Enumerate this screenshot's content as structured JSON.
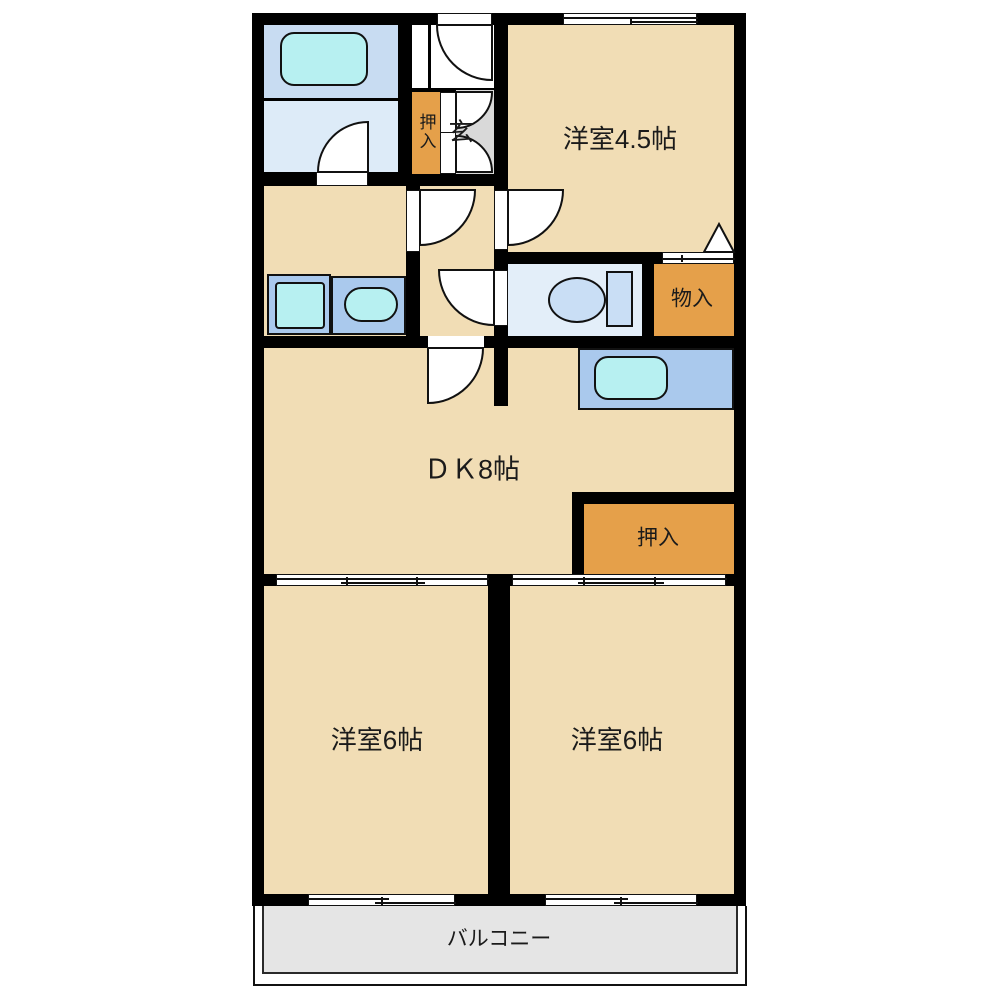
{
  "labels": {
    "western_room_45": "洋室4.5帖",
    "entrance": "玄",
    "closet_upper": "押入",
    "storage": "物入",
    "dining_kitchen": "ＤＫ8帖",
    "closet_dk": "押入",
    "western_room_6_left": "洋室6帖",
    "western_room_6_right": "洋室6帖",
    "balcony": "バルコニー"
  },
  "colors": {
    "wall": "#000000",
    "floor": "#f1ddb5",
    "closet": "#e5a04a",
    "entrance": "#d9d9d9",
    "balcony": "#e5e5e5",
    "bath": "#c8dcf2",
    "washroom": "#ddebf8",
    "toiletroom": "#e3eef9",
    "counter": "#aac9ed",
    "fixture": "#c9def5",
    "cyan": "#b7f0f1",
    "line": "#111111",
    "text": "#1b1b1b"
  },
  "fixtures": [
    "bathtub",
    "washing-machine",
    "washbasin",
    "toilet",
    "kitchen-sink"
  ]
}
